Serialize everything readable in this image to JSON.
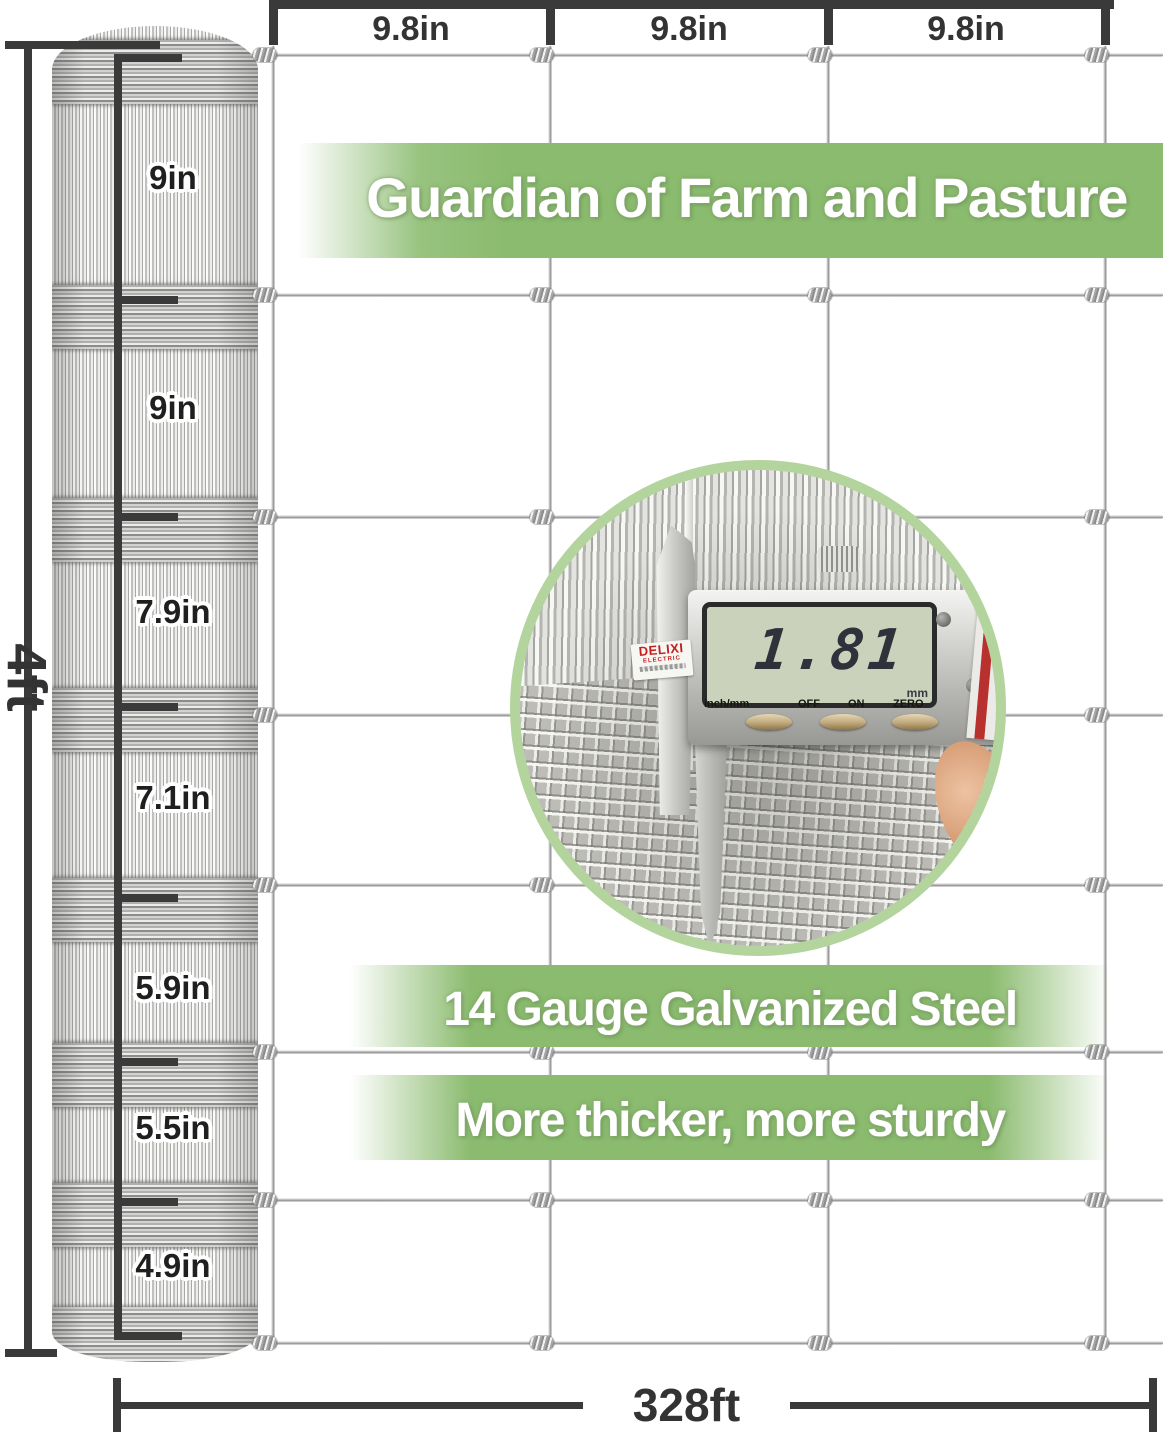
{
  "dimensions": {
    "top_spans": [
      "9.8in",
      "9.8in",
      "9.8in"
    ],
    "height_label": "4ft",
    "length_label": "328ft",
    "roll_segments": [
      "9in",
      "9in",
      "7.9in",
      "7.1in",
      "5.9in",
      "5.5in",
      "4.9in"
    ]
  },
  "banners": {
    "headline": "Guardian of Farm and Pasture",
    "feature_1": "14 Gauge Galvanized Steel",
    "feature_2": "More thicker, more sturdy"
  },
  "inset": {
    "display_value": "1.81",
    "display_unit": "mm",
    "caliper_labels": [
      "inch/mm",
      "OFF",
      "ON",
      "ZERO"
    ],
    "brand": "DELIXI",
    "brand_sub": "ELECTRIC"
  },
  "colors": {
    "banner_green": "#8abb6e",
    "ring_green": "#b3d49c",
    "dimension_dark": "#3a3a3a",
    "wire_gray": "#b5b5b5",
    "lcd_screen": "#cad2bc",
    "lcd_digits": "#31313b"
  }
}
